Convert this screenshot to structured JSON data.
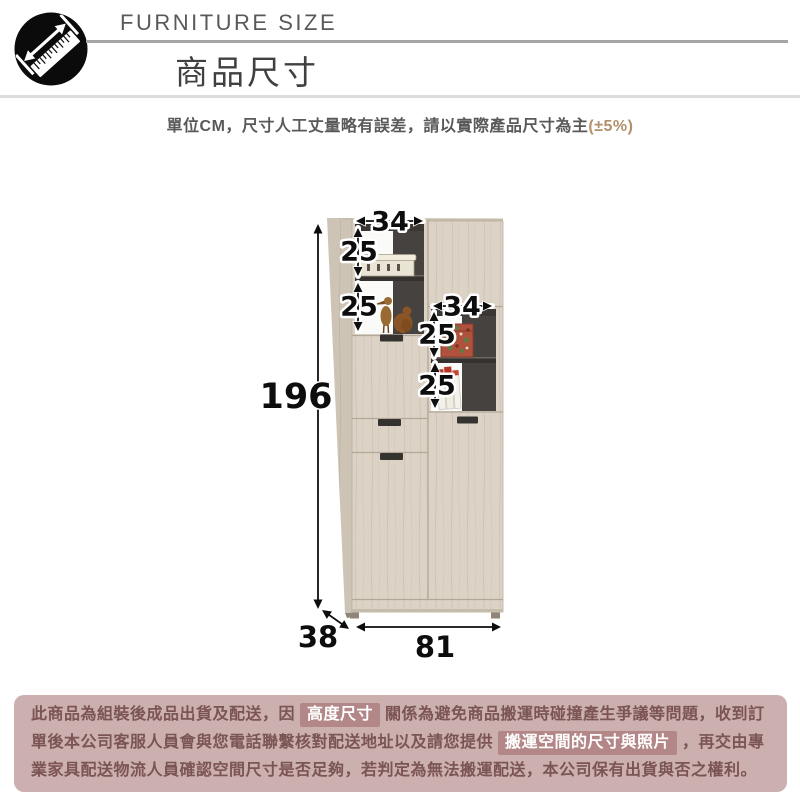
{
  "header": {
    "icon": "ruler-measure-icon",
    "eyebrow": "FURNITURE SIZE",
    "title": "商品尺寸",
    "note_main": "單位CM，尺寸人工丈量略有誤差，請以實際產品尺寸為主",
    "note_tolerance": "(±5%)"
  },
  "diagram": {
    "unit": "CM",
    "total_height": "196",
    "width": "81",
    "depth": "38",
    "upper_shelf_width": "34",
    "upper_shelf_cell_1": "25",
    "upper_shelf_cell_2": "25",
    "lower_shelf_width": "34",
    "lower_shelf_cell_1": "25",
    "lower_shelf_cell_2": "25"
  },
  "notice": {
    "part1": "此商品為組裝後成品出貨及配送，因",
    "chip1": "高度尺寸",
    "part2": "關係為避免商品搬運時碰撞產生爭議等問題，收到訂單後本公司客服人員會與您電話聯繫核對配送地址以及請您提供",
    "chip2": "搬運空間的尺寸與照片",
    "part3": "，再交由專業家具配送物流人員確認空間尺寸是否足夠，若判定為無法搬運配送，本公司保有出貨與否之權利。"
  },
  "colors": {
    "tolerance_accent": "#b2906a",
    "rule_dark": "#a5a5a5",
    "rule_light": "#dddddd",
    "notice_bg": "#ccafaf",
    "notice_text": "#7b5454",
    "chip_bg": "#b38787",
    "chip_text": "#ffffff",
    "wood": "#dcd3c6",
    "interior_dark": "#454240"
  }
}
